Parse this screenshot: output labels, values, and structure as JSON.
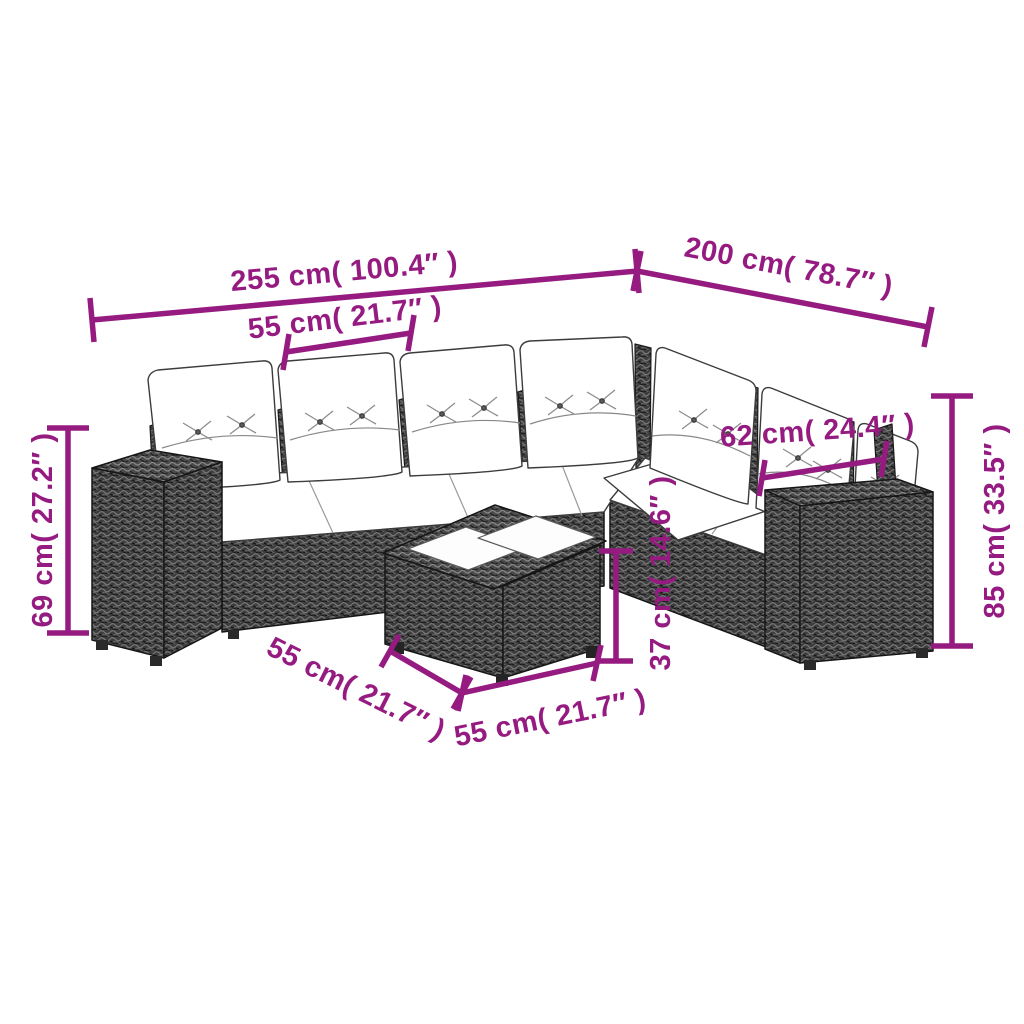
{
  "accent_color": "#951b81",
  "dimensions": {
    "sofa_length": "255 cm( 100.4″ )",
    "sofa_depth": "200 cm( 78.7″ )",
    "seat_module_width": "55 cm( 21.7″ )",
    "armrest_section_width": "62 cm( 24.4″ )",
    "seat_height": "69 cm( 27.2″ )",
    "total_height": "85 cm( 33.5″ )",
    "table_height": "37 cm( 14.6″ )",
    "table_side_length": "55 cm( 21.7″ )",
    "table_front_length": "55 cm( 21.7″ )"
  }
}
